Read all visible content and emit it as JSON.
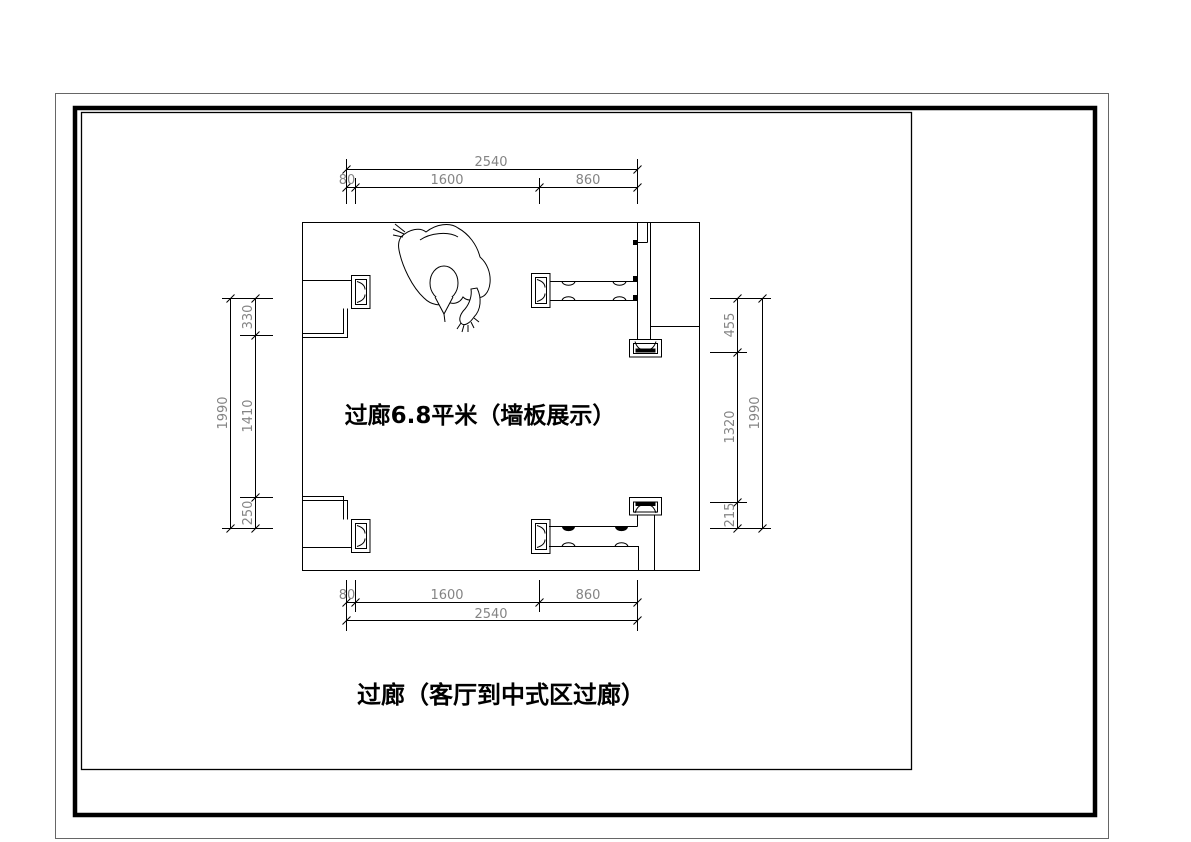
{
  "labels": {
    "area_label": "过廊6.8平米（墙板展示）",
    "caption": "过廊（客厅到中式区过廊）"
  },
  "dimensions": {
    "top": {
      "overall": "2540",
      "segments": [
        "80",
        "1600",
        "860"
      ]
    },
    "bottom": {
      "overall": "2540",
      "segments": [
        "80",
        "1600",
        "860"
      ]
    },
    "left": {
      "overall": "1990",
      "segments": [
        "330",
        "1410",
        "250"
      ]
    },
    "right": {
      "overall": "1990",
      "segments": [
        "455",
        "1320",
        "215"
      ]
    }
  },
  "colors": {
    "line": "#000000",
    "dim_text": "#848484",
    "outer_border": "#666666",
    "background": "#ffffff"
  }
}
